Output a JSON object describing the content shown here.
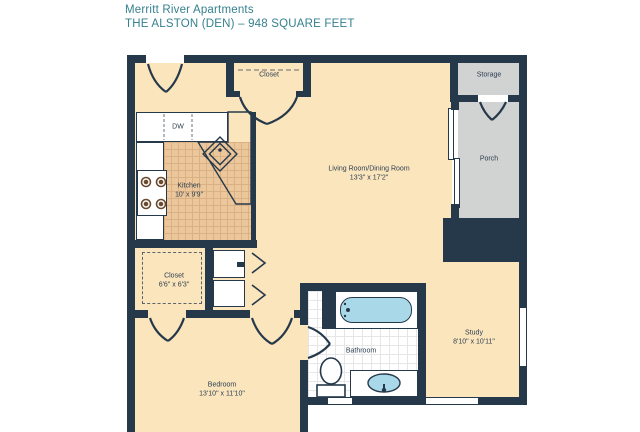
{
  "header": {
    "property_name": "Merritt River Apartments",
    "plan_title": "THE ALSTON (DEN) – 948 SQUARE FEET"
  },
  "rooms": {
    "living": {
      "name": "Living Room/Dining Room",
      "dims": "13'3\" x 17'2\""
    },
    "kitchen": {
      "name": "Kitchen",
      "dims": "10' x 9'9\""
    },
    "bedroom": {
      "name": "Bedroom",
      "dims": "13'10\" x 11'10\""
    },
    "study": {
      "name": "Study",
      "dims": "8'10\" x 10'11\""
    },
    "closet_bedroom": {
      "name": "Closet",
      "dims": "6'6\" x 6'3\""
    },
    "closet_entry": {
      "name": "Closet"
    },
    "bathroom": {
      "name": "Bathroom"
    },
    "porch": {
      "name": "Porch"
    },
    "storage": {
      "name": "Storage"
    },
    "dishwasher": {
      "abbr": "DW"
    }
  },
  "colors": {
    "wall": "#26394b",
    "cream": "#fbe5bd",
    "ktile": "#ecc79b",
    "kgrid": "#d9b185",
    "gray": "#d1d2d2",
    "bathgrid": "#e6e6e6",
    "blue": "#a9d9e9",
    "label": "#2c3e50",
    "title": "#35808e"
  }
}
